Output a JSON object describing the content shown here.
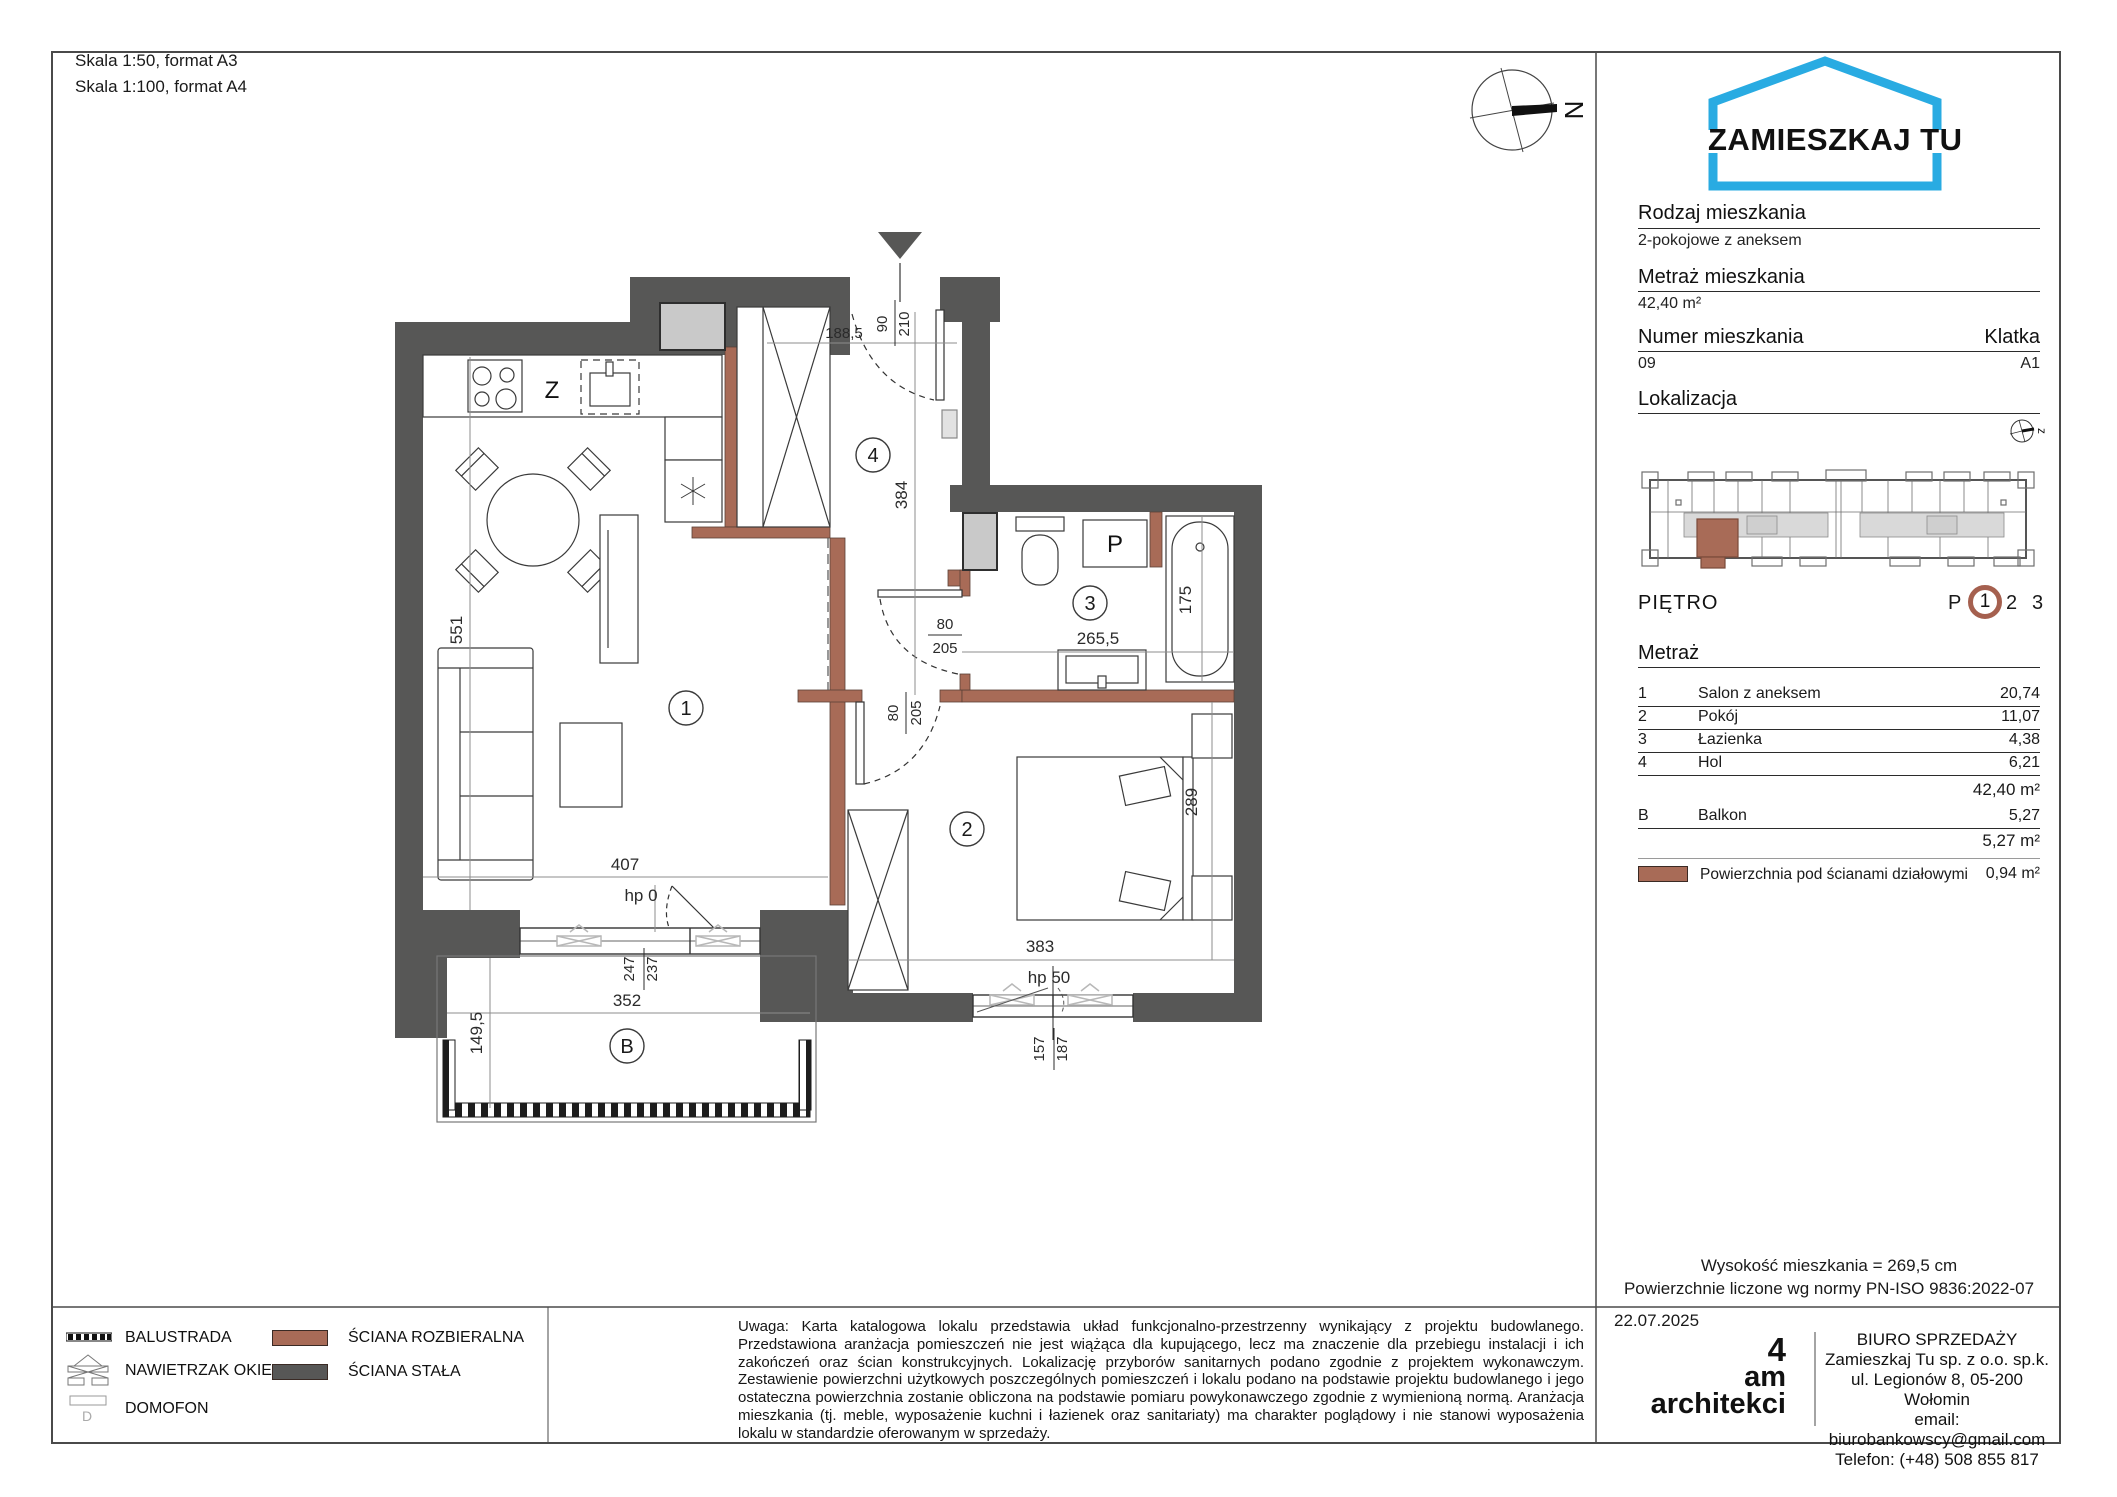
{
  "header": {
    "scale_a3": "Skala 1:50, format A3",
    "scale_a4": "Skala 1:100, format A4"
  },
  "brand": {
    "name": "ZAMIESZKAJ TU"
  },
  "compass": {
    "north": "N",
    "mini_north": "z"
  },
  "unit": {
    "rodzaj_label": "Rodzaj mieszkania",
    "rodzaj": "2-pokojowe z aneksem",
    "metraz_label": "Metraż mieszkania",
    "metraz": "42,40 m²",
    "numer_label": "Numer mieszkania",
    "numer": "09",
    "klatka_label": "Klatka",
    "klatka": "A1",
    "lokalizacja_label": "Lokalizacja"
  },
  "pietro": {
    "label": "PIĘTRO",
    "prefix": "P",
    "selected": "1",
    "opt2": "2",
    "opt3": "3"
  },
  "areas": {
    "label": "Metraż",
    "rows": [
      {
        "no": "1",
        "name": "Salon z aneksem",
        "value": "20,74"
      },
      {
        "no": "2",
        "name": "Pokój",
        "value": "11,07"
      },
      {
        "no": "3",
        "name": "Łazienka",
        "value": "4,38"
      },
      {
        "no": "4",
        "name": "Hol",
        "value": "6,21"
      }
    ],
    "total": "42,40 m²",
    "balkon": {
      "no": "B",
      "name": "Balkon",
      "value": "5,27"
    },
    "balkon_total": "5,27 m²",
    "partition_label": "Powierzchnia pod ścianami działowymi",
    "partition_value": "0,94 m²"
  },
  "notes": {
    "height": "Wysokość mieszkania =  269,5 cm",
    "norm": "Powierzchnie liczone wg normy PN-ISO 9836:2022-07"
  },
  "legend": {
    "balustrada": "BALUSTRADA",
    "nawietrzak": "NAWIETRZAK OKIENNY",
    "domofon": "DOMOFON",
    "sciana_rozbieralna": "ŚCIANA ROZBIERALNA",
    "sciana_stala": "ŚCIANA STAŁA"
  },
  "disclaimer": "Uwaga: Karta katalogowa lokalu przedstawia układ funkcjonalno-przestrzenny wynikający z projektu budowlanego. Przedstawiona aranżacja pomieszczeń nie jest wiążąca dla kupującego, lecz ma znaczenie dla przebiegu instalacji i ich zakończeń oraz ścian konstrukcyjnych. Lokalizację przyborów sanitarnych podano zgodnie z projektem wykonawczym. Zestawienie powierzchni użytkowych poszczególnych pomieszczeń i lokalu podano na podstawie projektu budowlanego i jego ostateczna powierzchnia zostanie obliczona na podstawie pomiaru powykonawczego zgodnie z wymienioną normą. Aranżacja mieszkania (tj. meble, wyposażenie kuchni i łazienek oraz sanitariaty) ma charakter poglądowy i nie stanowi wyposażenia lokalu w standardzie oferowanym w sprzedaży.",
  "footer": {
    "date": "22.07.2025",
    "studio_4": "4",
    "studio_am": "am",
    "studio_name": "architekci",
    "office_title": "BIURO SPRZEDAŻY",
    "office_company": "Zamieszkaj Tu sp. z o.o. sp.k.",
    "office_address": "ul. Legionów 8, 05-200 Wołomin",
    "office_email": "email: biurobankowscy@gmail.com",
    "office_phone": "Telefon: (+48) 508 855 817"
  },
  "plan": {
    "rooms": {
      "salon": "1",
      "pokoj": "2",
      "lazienka": "3",
      "hol": "4",
      "balkon": "B"
    },
    "fixtures": {
      "dishwasher": "Z",
      "washer": "P"
    },
    "dims": {
      "salon_height": "551",
      "salon_width": "407",
      "salon_hp": "hp 0",
      "balcony_door_a": "247",
      "balcony_door_b": "237",
      "balkon_width": "352",
      "balkon_depth": "149,5",
      "pokoj_width": "383",
      "pokoj_hp": "hp 50",
      "window_a": "157",
      "window_b": "187",
      "pokoj_height": "289",
      "tub": "175",
      "lazienka_width": "265,5",
      "door_w": "80",
      "door_h": "205",
      "hol_height": "384",
      "hol_width": "188,5",
      "entry_w": "90",
      "entry_h": "210"
    }
  },
  "colors": {
    "accent_blue": "#29ABE2",
    "wall_dark": "#575756",
    "wall_brown": "#A86B57",
    "ring_brown": "#A5604F"
  }
}
